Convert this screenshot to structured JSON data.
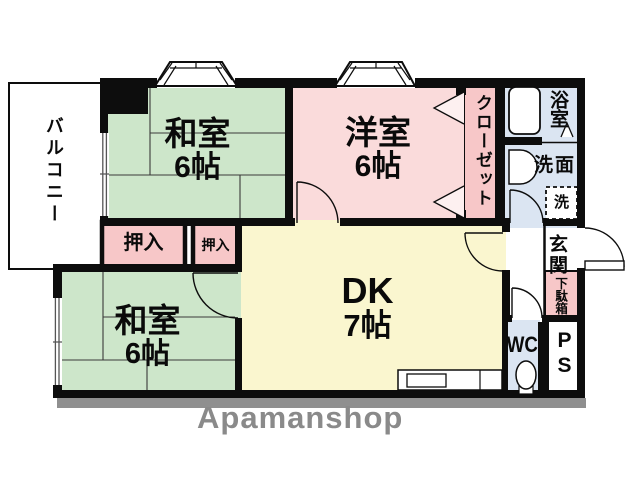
{
  "floorplan": {
    "balcony": {
      "label": "バルコニー"
    },
    "washitsu_top": {
      "name": "和室",
      "size": "6帖"
    },
    "youshitsu": {
      "name": "洋室",
      "size": "6帖"
    },
    "closet": {
      "label": "クローゼット"
    },
    "bath": {
      "label": "浴室"
    },
    "senmen": {
      "label": "洗面"
    },
    "washer": {
      "label": "洗"
    },
    "genkan": {
      "label": "玄関"
    },
    "getabako": {
      "label": "下駄箱"
    },
    "wc": {
      "label": "WC"
    },
    "ps": {
      "label": "PS"
    },
    "dk": {
      "name": "DK",
      "size": "7帖"
    },
    "oshiire_left": {
      "label": "押入"
    },
    "oshiire_right": {
      "label": "押入"
    },
    "washitsu_bottom": {
      "name": "和室",
      "size": "6帖"
    },
    "watermark": "Apamanshop",
    "colors": {
      "tatami_green": "#cde6ca",
      "western_pink": "#fadbdb",
      "storage_pink": "#f7c7c8",
      "water_blue": "#dbe5f2",
      "dk_yellow": "#faf6cf",
      "wall_black": "#0d0d0d",
      "shadow_gray": "#8f8f8f"
    }
  }
}
